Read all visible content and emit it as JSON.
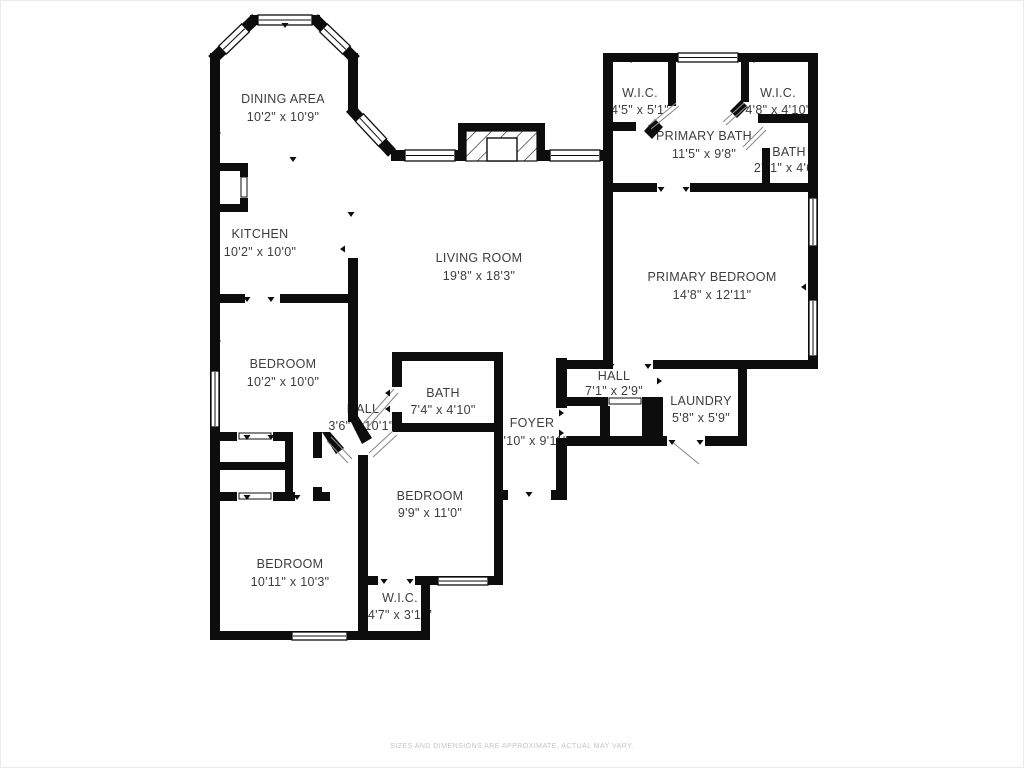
{
  "rooms": [
    {
      "name": "DINING AREA",
      "dims": "10'2\" x 10'9\""
    },
    {
      "name": "KITCHEN",
      "dims": "10'2\" x 10'0\""
    },
    {
      "name": "LIVING ROOM",
      "dims": "19'8\" x 18'3\""
    },
    {
      "name": "W.I.C.",
      "dims": "4'5\" x 5'1\""
    },
    {
      "name": "W.I.C.",
      "dims": "4'8\" x 4'10\""
    },
    {
      "name": "PRIMARY BATH",
      "dims": "11'5\" x 9'8\""
    },
    {
      "name": "BATH",
      "dims": "2'11\" x 4'6\""
    },
    {
      "name": "PRIMARY BEDROOM",
      "dims": "14'8\" x 12'11\""
    },
    {
      "name": "BEDROOM",
      "dims": "10'2\" x 10'0\""
    },
    {
      "name": "HALL",
      "dims": "3'6\" x 10'1\""
    },
    {
      "name": "BATH",
      "dims": "7'4\" x 4'10\""
    },
    {
      "name": "FOYER",
      "dims": "4'10\" x 9'11\""
    },
    {
      "name": "HALL",
      "dims": "7'1\" x 2'9\""
    },
    {
      "name": "LAUNDRY",
      "dims": "5'8\" x 5'9\""
    },
    {
      "name": "BEDROOM",
      "dims": "9'9\" x 11'0\""
    },
    {
      "name": "BEDROOM",
      "dims": "10'11\" x 10'3\""
    },
    {
      "name": "W.I.C.",
      "dims": "4'7\" x 3'11\""
    }
  ],
  "footer": {
    "disclaimer": "SIZES AND DIMENSIONS ARE APPROXIMATE, ACTUAL MAY VARY."
  },
  "colors": {
    "wall": "#0d0d0d",
    "room_label": "#3d3d3d",
    "disclaimer_text": "#c4c4c4",
    "background": "#ffffff"
  }
}
